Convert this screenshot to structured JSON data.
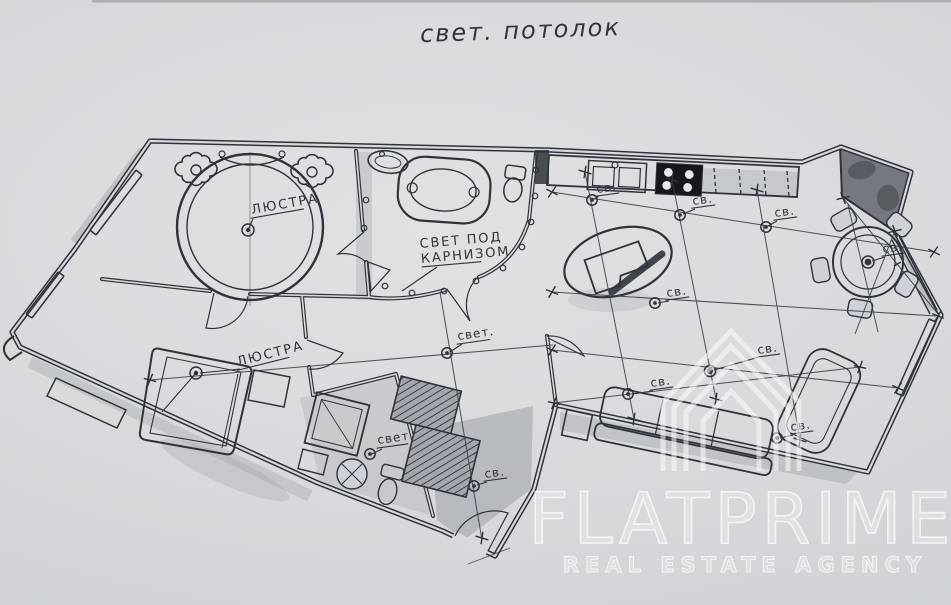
{
  "title": "свет. потолок",
  "plan": {
    "labels": {
      "chandelier": "ЛЮСТРА",
      "cornice_line1": "СВЕТ ПОД",
      "cornice_line2": "КАРНИЗОМ",
      "hall_light": "свет.",
      "bath_light": "свет",
      "spot": "св."
    }
  },
  "watermark": {
    "brand": "FLATPRIME",
    "subtitle": "REAL ESTATE AGENCY"
  },
  "colors": {
    "ink": "#2f343b",
    "paper": "#d7d9dc",
    "pencil_shade": "#84878d",
    "watermark": "#f2f3f4"
  }
}
